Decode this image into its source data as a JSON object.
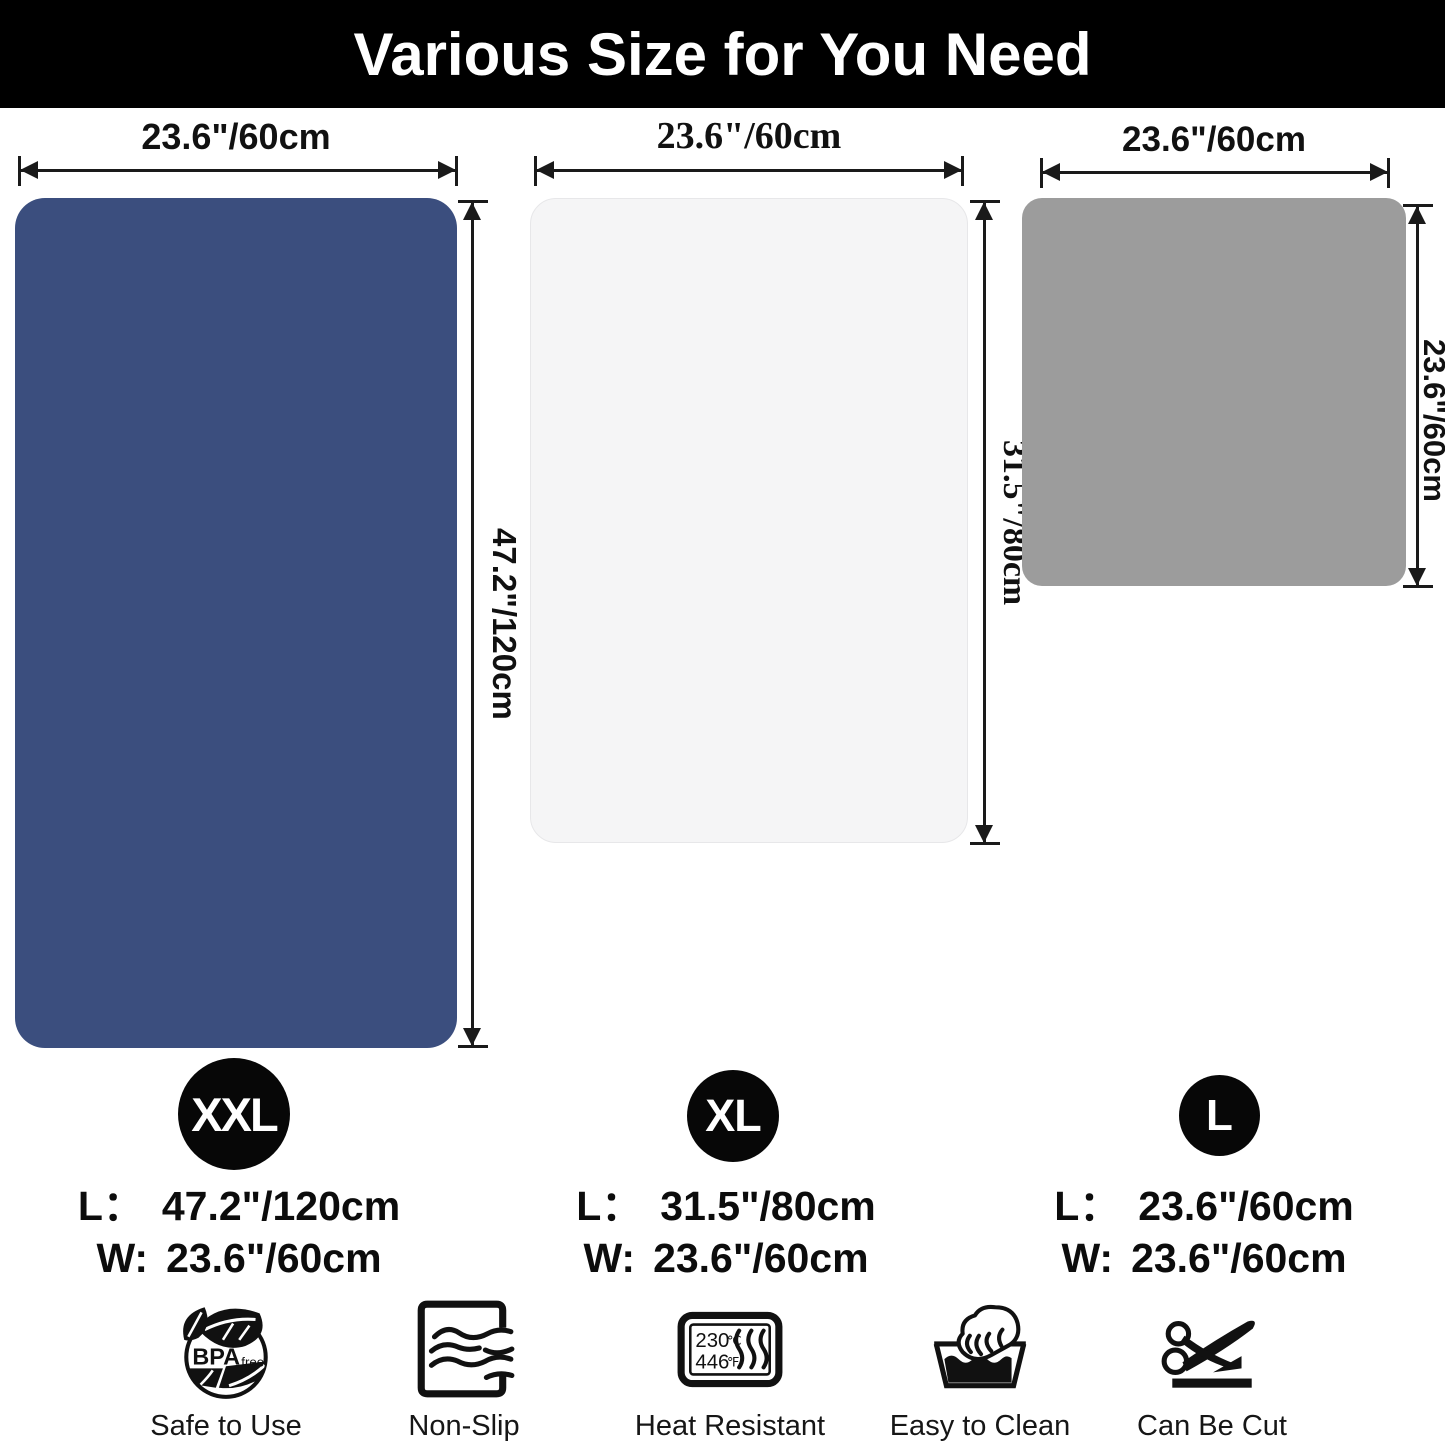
{
  "title": "Various Size for You Need",
  "colors": {
    "banner": "#000000",
    "arrow": "#1a1a1a",
    "badge": "#070707",
    "mat_xxl": "#3b4e7e",
    "mat_xl": "#f5f5f6",
    "mat_l": "#9c9c9c"
  },
  "sizes": [
    {
      "badge": "XXL",
      "top_dim": "23.6\"/60cm",
      "side_dim": "47.2\"/120cm",
      "l_label": "L：",
      "l_value": "47.2\"/120cm",
      "w_label": "W:",
      "w_value": "23.6\"/60cm",
      "color": "#3b4e7e"
    },
    {
      "badge": "XL",
      "top_dim": "23.6\"/60cm",
      "side_dim": "31.5\"/80cm",
      "l_label": "L：",
      "l_value": "31.5\"/80cm",
      "w_label": "W:",
      "w_value": "23.6\"/60cm",
      "color": "#f5f5f6"
    },
    {
      "badge": "L",
      "top_dim": "23.6\"/60cm",
      "side_dim": "23.6\"/60cm",
      "l_label": "L：",
      "l_value": "23.6\"/60cm",
      "w_label": "W:",
      "w_value": "23.6\"/60cm",
      "color": "#9c9c9c"
    }
  ],
  "features": [
    {
      "icon": "bpa-free-icon",
      "label": "Safe to Use",
      "text_main": "BPA",
      "text_sub": "free"
    },
    {
      "icon": "non-slip-icon",
      "label": "Non-Slip"
    },
    {
      "icon": "heat-resistant-icon",
      "label": "Heat Resistant",
      "temps": {
        "c_value": "230",
        "c_unit": "℃",
        "f_value": "446",
        "f_unit": "℉"
      }
    },
    {
      "icon": "easy-to-clean-icon",
      "label": "Easy to Clean"
    },
    {
      "icon": "can-be-cut-icon",
      "label": "Can Be Cut"
    }
  ]
}
